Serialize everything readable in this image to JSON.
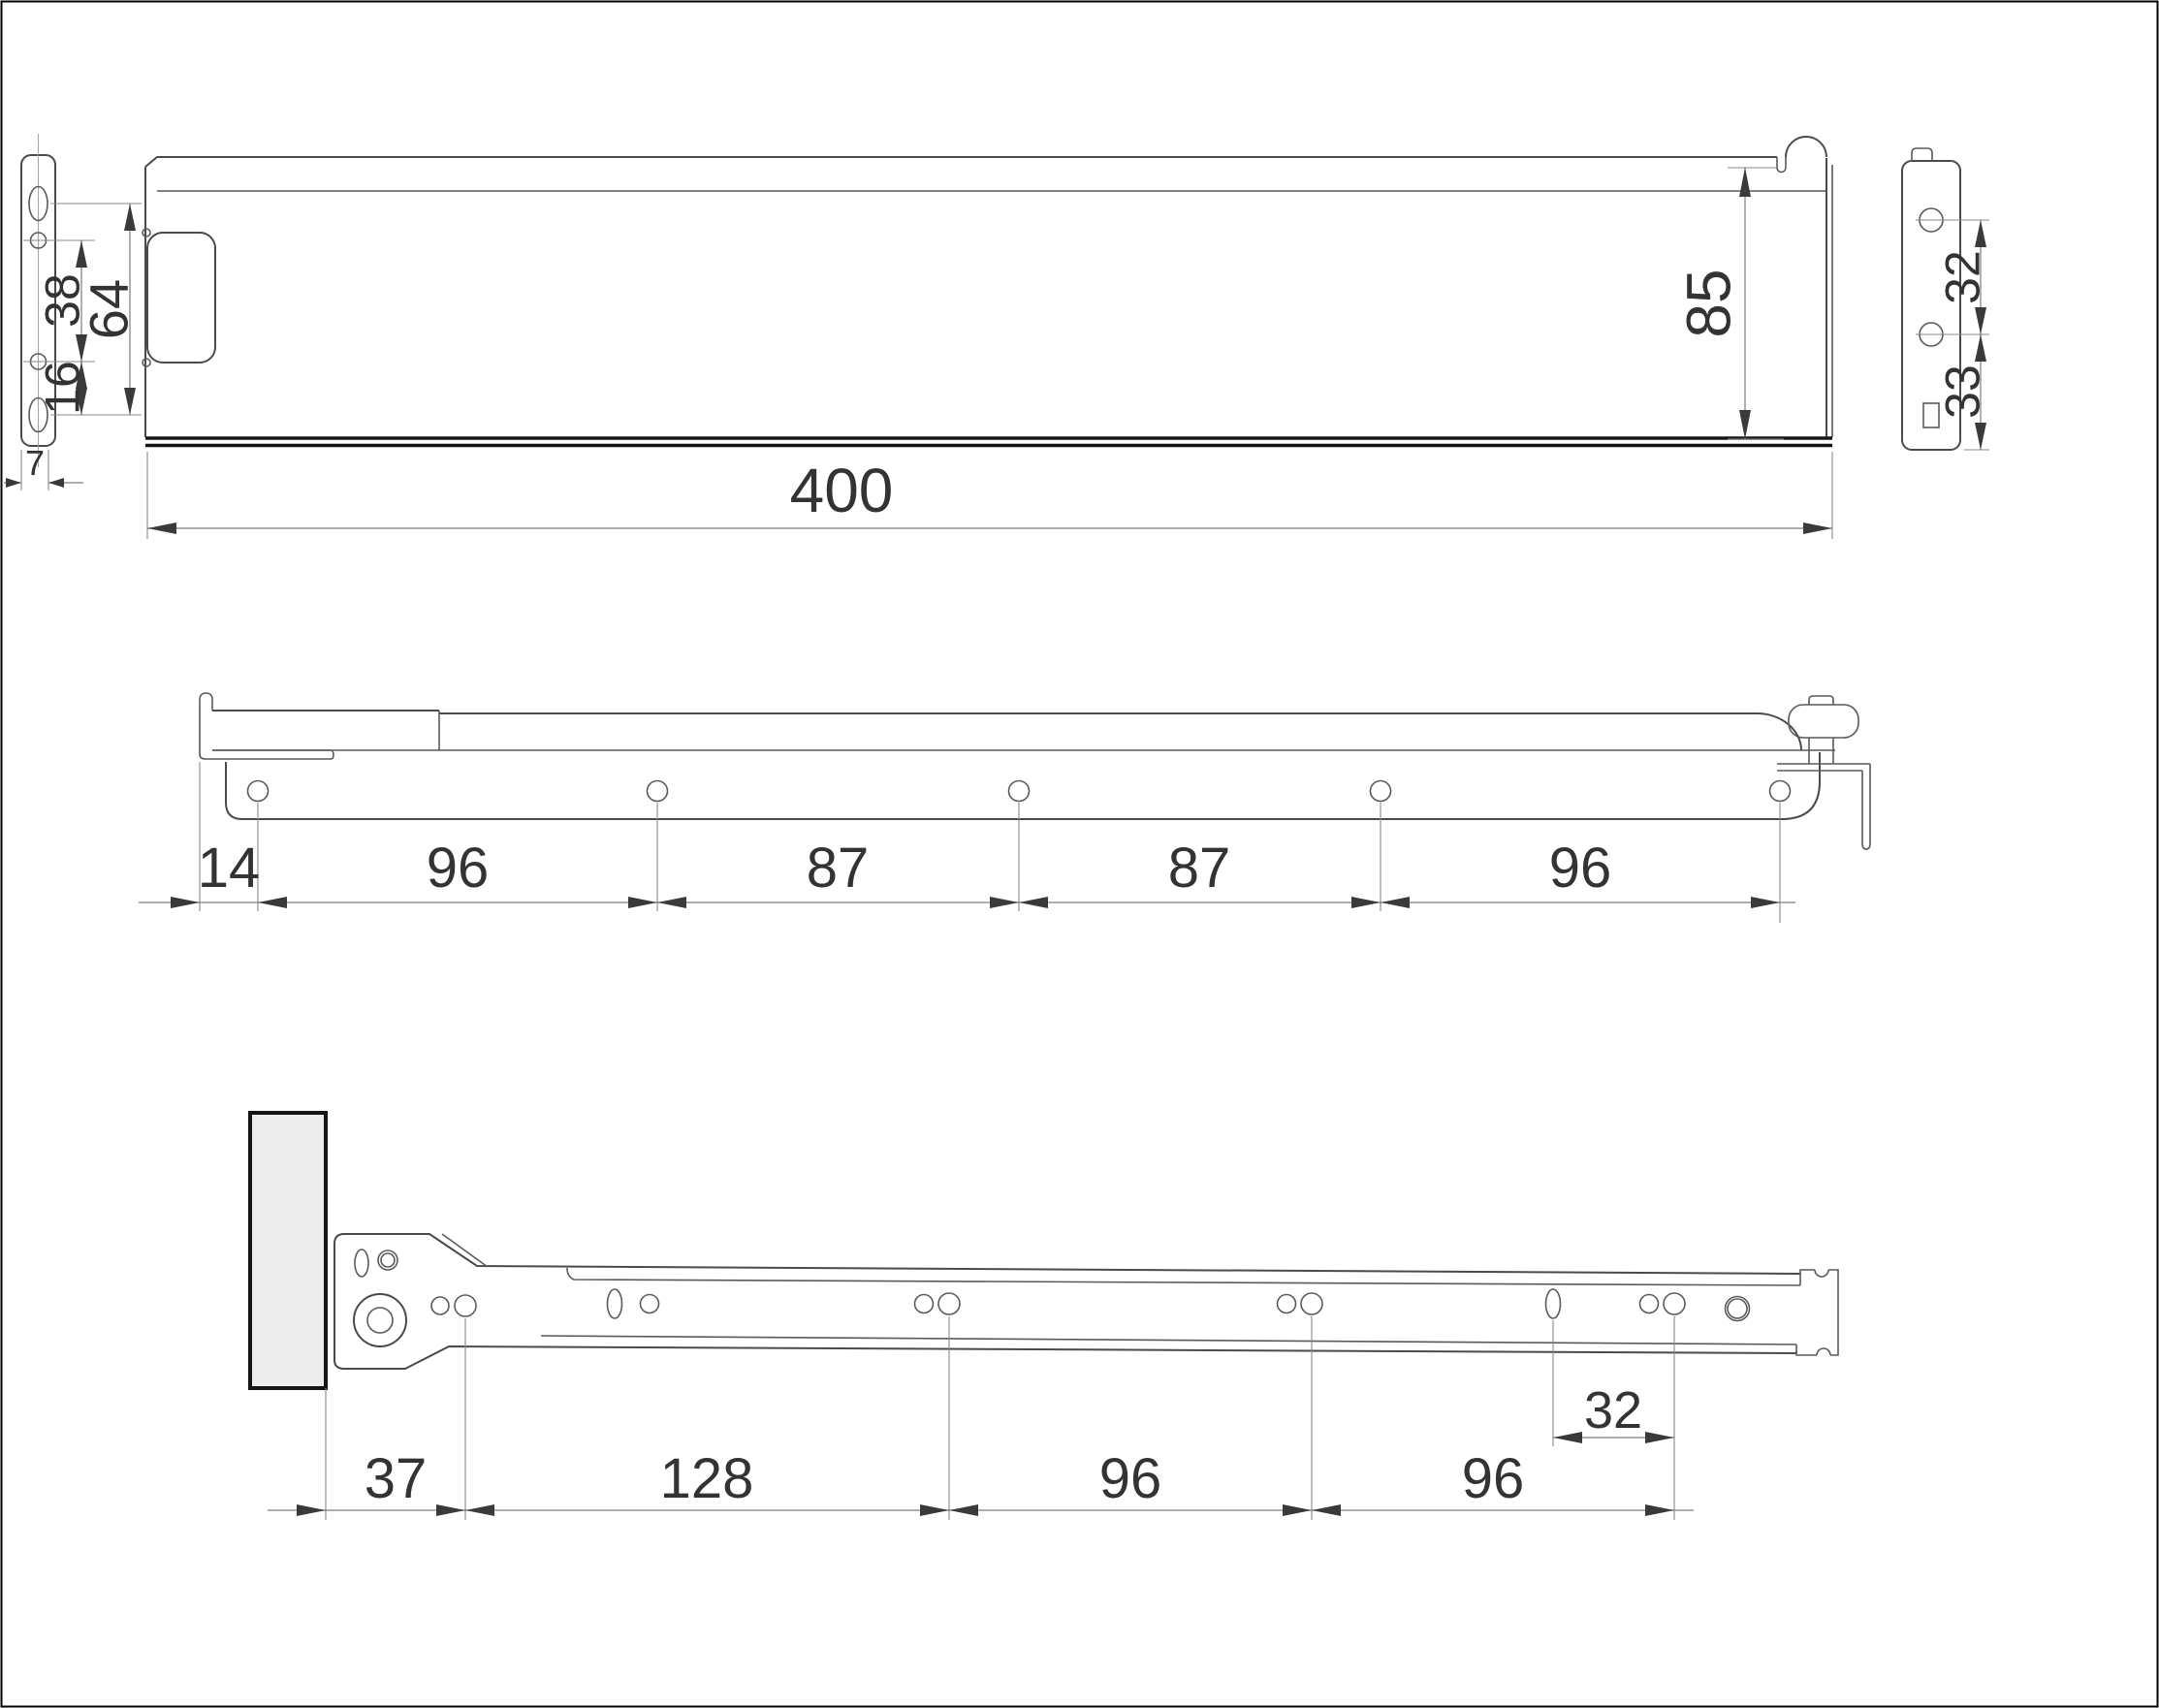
{
  "colors": {
    "outline": "#4a4a4a",
    "dimension_lines": "#7d7d7d",
    "text": "#333333",
    "wood_panel_fill": "#ececec",
    "frame_border": "#000000"
  },
  "views": {
    "side": {
      "length": "400",
      "height": "85",
      "front_plate": {
        "hole_pitch": "38",
        "slot_pitch": "64",
        "lower_offset": "16",
        "thickness": "7"
      },
      "back_plate": {
        "hole_pitch": "32",
        "bottom_offset": "33"
      }
    },
    "drawer_rail": {
      "dims": [
        "14",
        "96",
        "87",
        "87",
        "96"
      ]
    },
    "cabinet_rail": {
      "dims": [
        "37",
        "128",
        "96",
        "96"
      ],
      "end_hole_pitch": "32"
    }
  }
}
